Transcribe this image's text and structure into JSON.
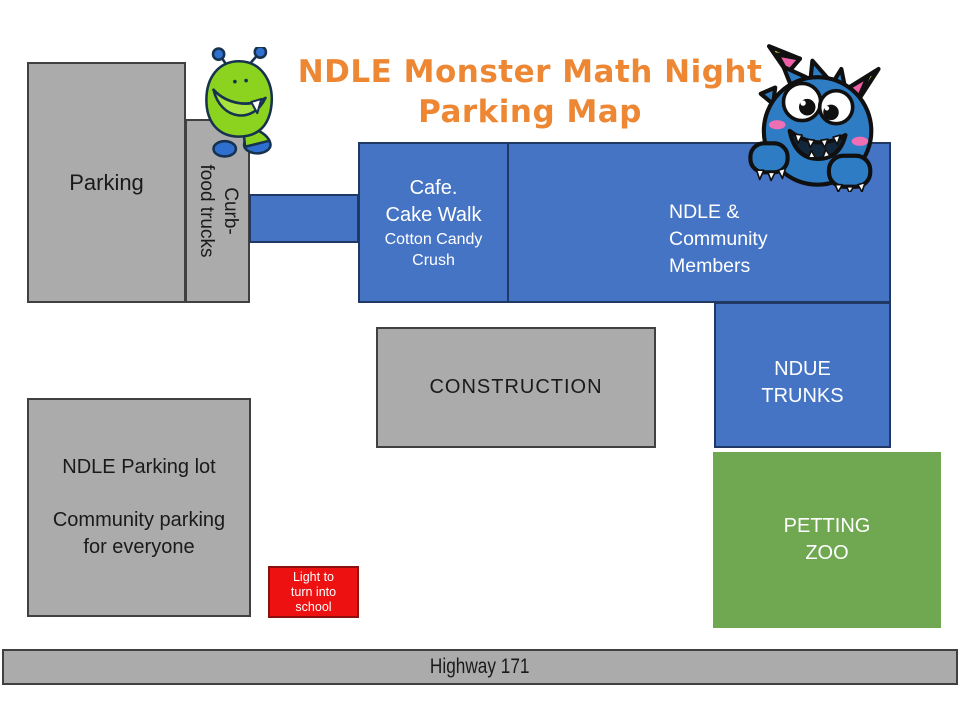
{
  "title": {
    "line1": "NDLE Monster Math Night",
    "line2": "Parking Map"
  },
  "map": {
    "parking": {
      "label": "Parking"
    },
    "curb": {
      "line1": "Curb-",
      "line2": "food trucks"
    },
    "cafe": {
      "line1": "Cafe.",
      "line2": "Cake Walk",
      "line3": "Cotton Candy",
      "line4": "Crush"
    },
    "community": {
      "line1": "NDLE &",
      "line2": "Community",
      "line3": "Members"
    },
    "construction": {
      "label": "CONSTRUCTION"
    },
    "ndue_trunks": {
      "line1": "NDUE",
      "line2": "TRUNKS"
    },
    "petting_zoo": {
      "line1": "PETTING",
      "line2": "ZOO"
    },
    "ndle_lot": {
      "para1": "NDLE Parking lot",
      "para2_line1": "Community parking",
      "para2_line2": "for everyone"
    },
    "light_sign": {
      "line1": "Light to",
      "line2": "turn into",
      "line3": "school"
    },
    "highway": {
      "label": "Highway 171"
    }
  },
  "icons": {
    "green_monster": "green-monster-icon",
    "blue_monster": "blue-monster-icon"
  },
  "colors": {
    "title_orange": "#ED8733",
    "box_blue": "#4674C5",
    "box_blue_border": "#1F3864",
    "box_gray": "#ABABAB",
    "box_gray_border": "#404040",
    "box_green": "#6FA850",
    "box_red": "#EE1111",
    "text_dark": "#111111",
    "text_white": "#FFFFFF"
  }
}
